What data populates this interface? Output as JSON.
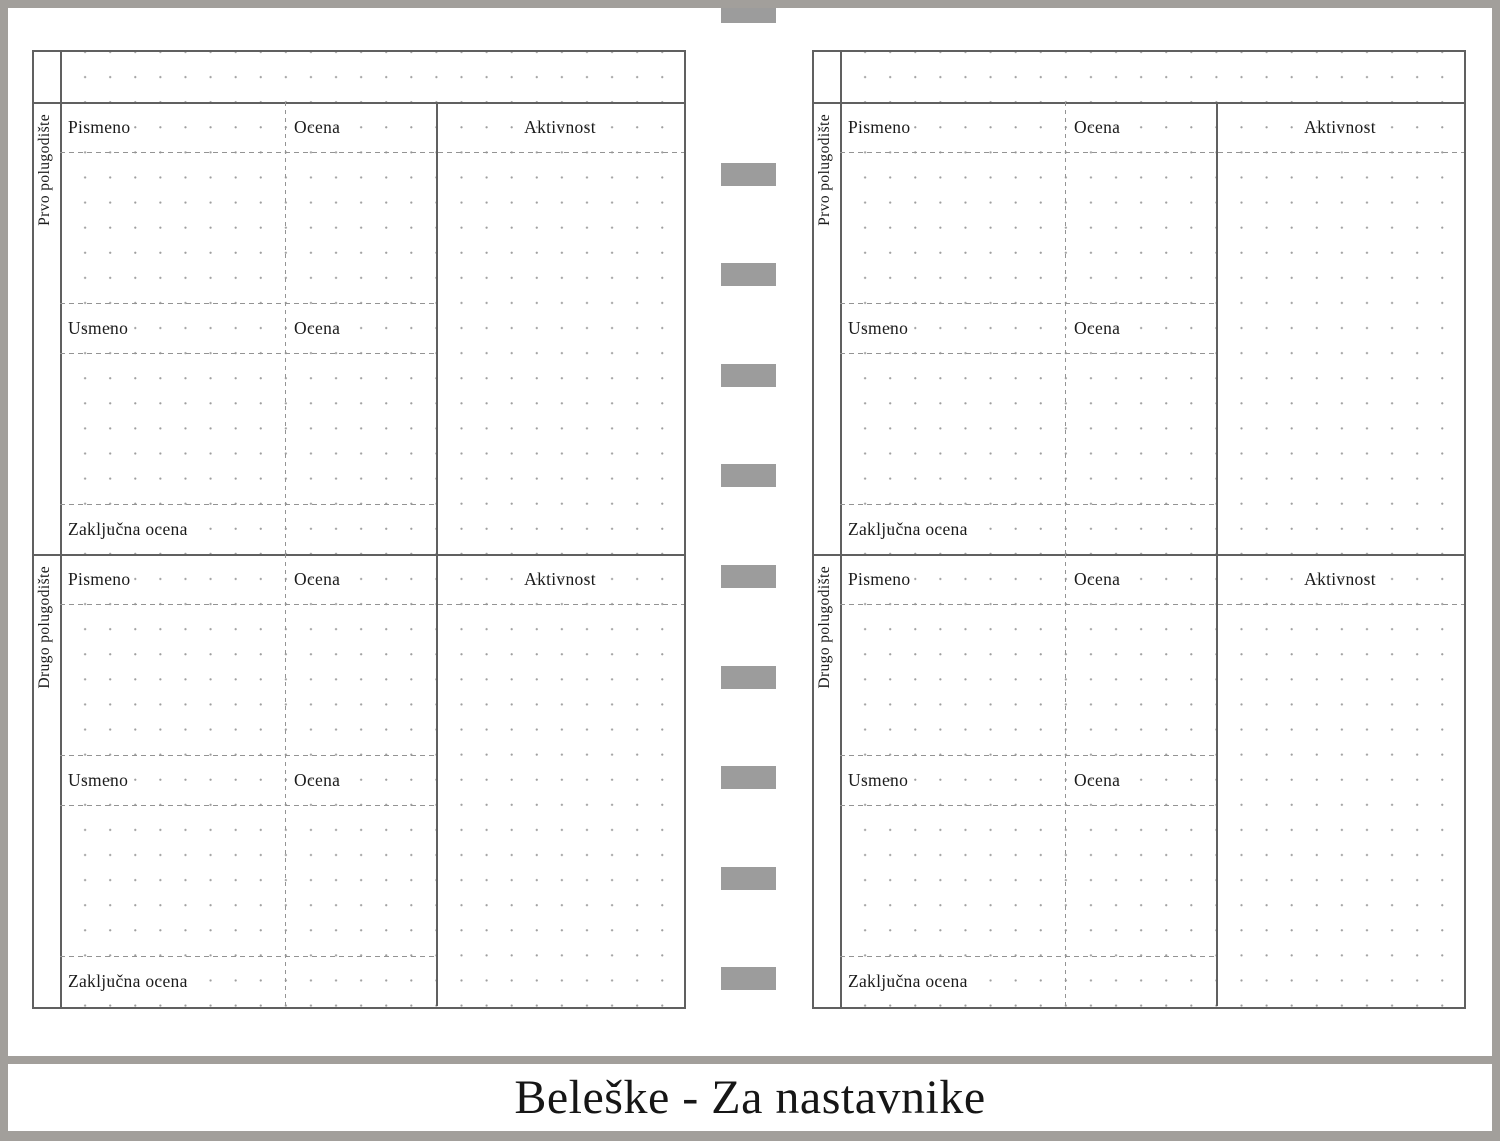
{
  "title": "Beleške - Za nastavnike",
  "page": {
    "sections": [
      {
        "side_label": "Prvo polugodište",
        "written_label": "Pismeno",
        "written_grade_label": "Ocena",
        "activity_label": "Aktivnost",
        "oral_label": "Usmeno",
        "oral_grade_label": "Ocena",
        "final_grade_label": "Zaključna ocena"
      },
      {
        "side_label": "Drugo polugodište",
        "written_label": "Pismeno",
        "written_grade_label": "Ocena",
        "activity_label": "Aktivnost",
        "oral_label": "Usmeno",
        "oral_grade_label": "Ocena",
        "final_grade_label": "Zaključna ocena"
      }
    ]
  },
  "binder": {
    "tab_count": 10,
    "tab_icon": "binder-tab"
  },
  "colors": {
    "frame": "#a29f9b",
    "binder_tab": "#9c9c9c",
    "solid_line": "#606060",
    "dashed_line": "#949494",
    "dot": "#9e9e9e",
    "text": "#1b1b1b"
  }
}
